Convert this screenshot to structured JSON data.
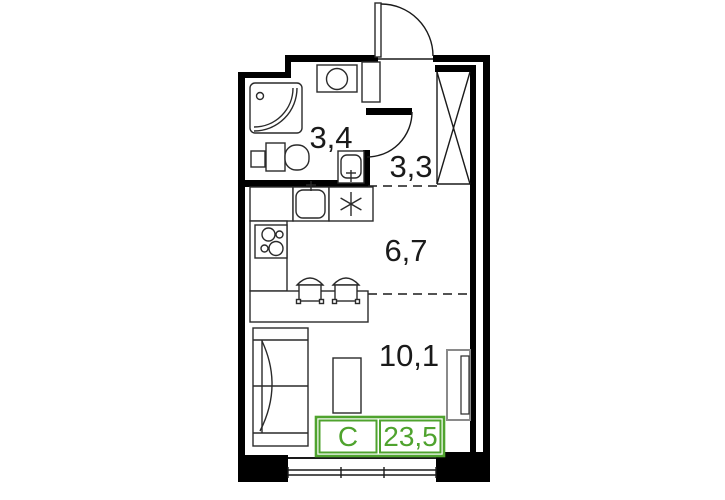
{
  "plan": {
    "rooms": {
      "bathroom": {
        "area": "3,4"
      },
      "hallway": {
        "area": "3,3"
      },
      "kitchen": {
        "area": "6,7"
      },
      "living": {
        "area": "10,1"
      }
    },
    "summary": {
      "type": "С",
      "total_area": "23,5"
    },
    "colors": {
      "green": "#4FA32E",
      "wall": "#000000",
      "line": "#1a1a1a",
      "radiator_gray": "#8a8a8a"
    }
  }
}
